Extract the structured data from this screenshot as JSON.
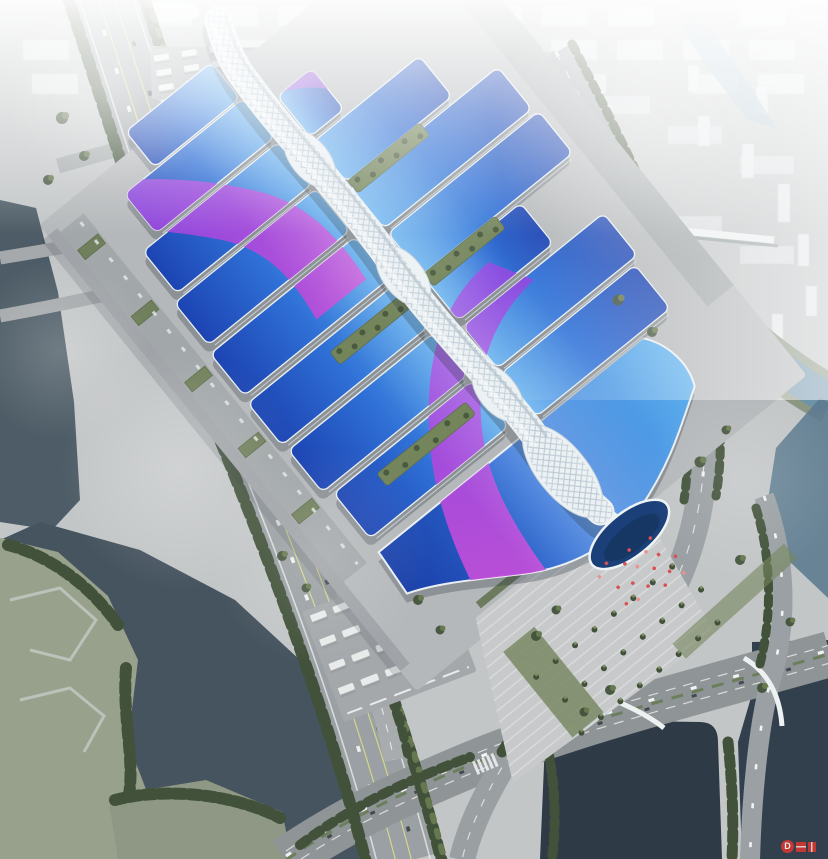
{
  "palette": {
    "ground": "#c3c6c7",
    "complexGround": "#b5b8ba",
    "plaza": "#c7c9ca",
    "roadMain": "#9aa0a3",
    "roadMinor": "#a8acae",
    "laneYellow": "#d4d788",
    "markWhite": "#eceeee",
    "waterLeft": "#4d5c66",
    "waterRiver": "#46545f",
    "waterPond": "#2e3a45",
    "waterCanal": "#6e93a9",
    "bankGreen": "#8a9681",
    "treeDark": "#42523a",
    "treeMid": "#66784f",
    "lawn": "#74855c",
    "roofDeep": "#1c44b2",
    "roofMid": "#2f6fd6",
    "roofLight": "#55a8ec",
    "roofBright": "#5fb2ee",
    "ribbonMagenta": "#c84fd8",
    "ribbonViolet": "#8a43e0",
    "spineWhite": "#ecf1f4",
    "spineShade": "#aebdc7",
    "shellBlue": "#1b3f78",
    "trimWhite": "#e9eff3",
    "shadow": "#333d49",
    "flagRed": "#d65252",
    "watermarkRed": "#d8382f",
    "cityFill": "#e6eaec",
    "hazeWhite": "#ffffff"
  },
  "scene": {
    "watermark": {
      "letter": "D"
    },
    "complex": {
      "rows": [
        {
          "ly": -42,
          "lh": 46,
          "lx1": -126,
          "lx2": -16
        },
        {
          "ly": 6,
          "lh": 50,
          "lx1": -166,
          "lx2": -14,
          "ry": 26,
          "rh": 52,
          "rx1": 14,
          "rx2": 58
        },
        {
          "ly": 62,
          "lh": 54,
          "lx1": -188,
          "lx2": -14,
          "ry": 84,
          "rh": 52,
          "rx1": 14,
          "rx2": 150
        },
        {
          "ly": 122,
          "lh": 54,
          "lx1": -196,
          "lx2": -14,
          "ry": 142,
          "rh": 54,
          "rx1": 14,
          "rx2": 204
        },
        {
          "ly": 184,
          "lh": 54,
          "lx1": -200,
          "lx2": -14,
          "ry": 202,
          "rh": 54,
          "rx1": 14,
          "rx2": 208
        },
        {
          "ly": 246,
          "lh": 54,
          "lx1": -202,
          "lx2": -14,
          "ry": 262,
          "rh": 52,
          "rx1": 14,
          "rx2": 136
        },
        {
          "ly": 308,
          "lh": 54,
          "lx1": -200,
          "lx2": -14,
          "ry": 322,
          "rh": 54,
          "rx1": 14,
          "rx2": 194
        },
        {
          "ly": 370,
          "lh": 58,
          "lx1": -192,
          "lx2": -14,
          "ry": 382,
          "rh": 56,
          "rx1": 14,
          "rx2": 186
        }
      ],
      "courtyards": [
        [
          16,
          136,
          92,
          16
        ],
        [
          -106,
          258,
          90,
          16
        ],
        [
          16,
          256,
          92,
          16
        ],
        [
          -146,
          382,
          114,
          16
        ]
      ],
      "serviceBuildingYs": [
        20,
        105,
        190,
        275,
        360
      ]
    },
    "plaza": {
      "flags": [
        [
          -38,
          602
        ],
        [
          -24,
          596
        ],
        [
          -10,
          608
        ],
        [
          2,
          600
        ],
        [
          14,
          612
        ],
        [
          26,
          604
        ],
        [
          -30,
          622
        ],
        [
          -16,
          628
        ],
        [
          -2,
          618
        ],
        [
          10,
          630
        ],
        [
          22,
          622
        ],
        [
          34,
          634
        ],
        [
          -22,
          644
        ],
        [
          -6,
          640
        ],
        [
          8,
          650
        ],
        [
          20,
          642
        ],
        [
          30,
          652
        ],
        [
          -34,
          640
        ]
      ]
    },
    "city": {
      "towers": [
        [
          298,
          34,
          13,
          40
        ],
        [
          332,
          62,
          12,
          34
        ],
        [
          424,
          52,
          13,
          38
        ],
        [
          466,
          84,
          12,
          32
        ],
        [
          530,
          92,
          12,
          34
        ],
        [
          586,
          116,
          13,
          38
        ],
        [
          606,
          170,
          12,
          46
        ],
        [
          586,
          212,
          11,
          36
        ],
        [
          634,
          236,
          12,
          40
        ],
        [
          664,
          258,
          11,
          34
        ],
        [
          698,
          116,
          12,
          30
        ],
        [
          742,
          144,
          12,
          34
        ],
        [
          778,
          184,
          12,
          38
        ],
        [
          798,
          234,
          11,
          32
        ],
        [
          756,
          86,
          12,
          28
        ],
        [
          688,
          66,
          11,
          26
        ],
        [
          806,
          286,
          11,
          30
        ],
        [
          772,
          314,
          11,
          28
        ]
      ]
    },
    "trees": [
      [
        62,
        118,
        1.2
      ],
      [
        84,
        156,
        1
      ],
      [
        48,
        180,
        1
      ],
      [
        618,
        300,
        1.1
      ],
      [
        652,
        332,
        1
      ],
      [
        700,
        462,
        1.1
      ],
      [
        726,
        430,
        0.9
      ],
      [
        536,
        636,
        1
      ],
      [
        556,
        610,
        0.9
      ],
      [
        418,
        600,
        1
      ],
      [
        440,
        630,
        0.9
      ],
      [
        610,
        690,
        1
      ],
      [
        584,
        712,
        0.9
      ],
      [
        762,
        688,
        1
      ],
      [
        306,
        588,
        0.9
      ],
      [
        282,
        556,
        1
      ],
      [
        740,
        560,
        1
      ],
      [
        790,
        622,
        0.9
      ]
    ],
    "fog": [
      [
        180,
        470,
        120,
        0.22
      ],
      [
        640,
        120,
        150,
        0.3
      ],
      [
        110,
        85,
        110,
        0.3
      ],
      [
        320,
        556,
        110,
        0.16
      ],
      [
        745,
        480,
        100,
        0.15
      ],
      [
        60,
        350,
        90,
        0.2
      ],
      [
        420,
        210,
        120,
        0.12
      ]
    ]
  }
}
